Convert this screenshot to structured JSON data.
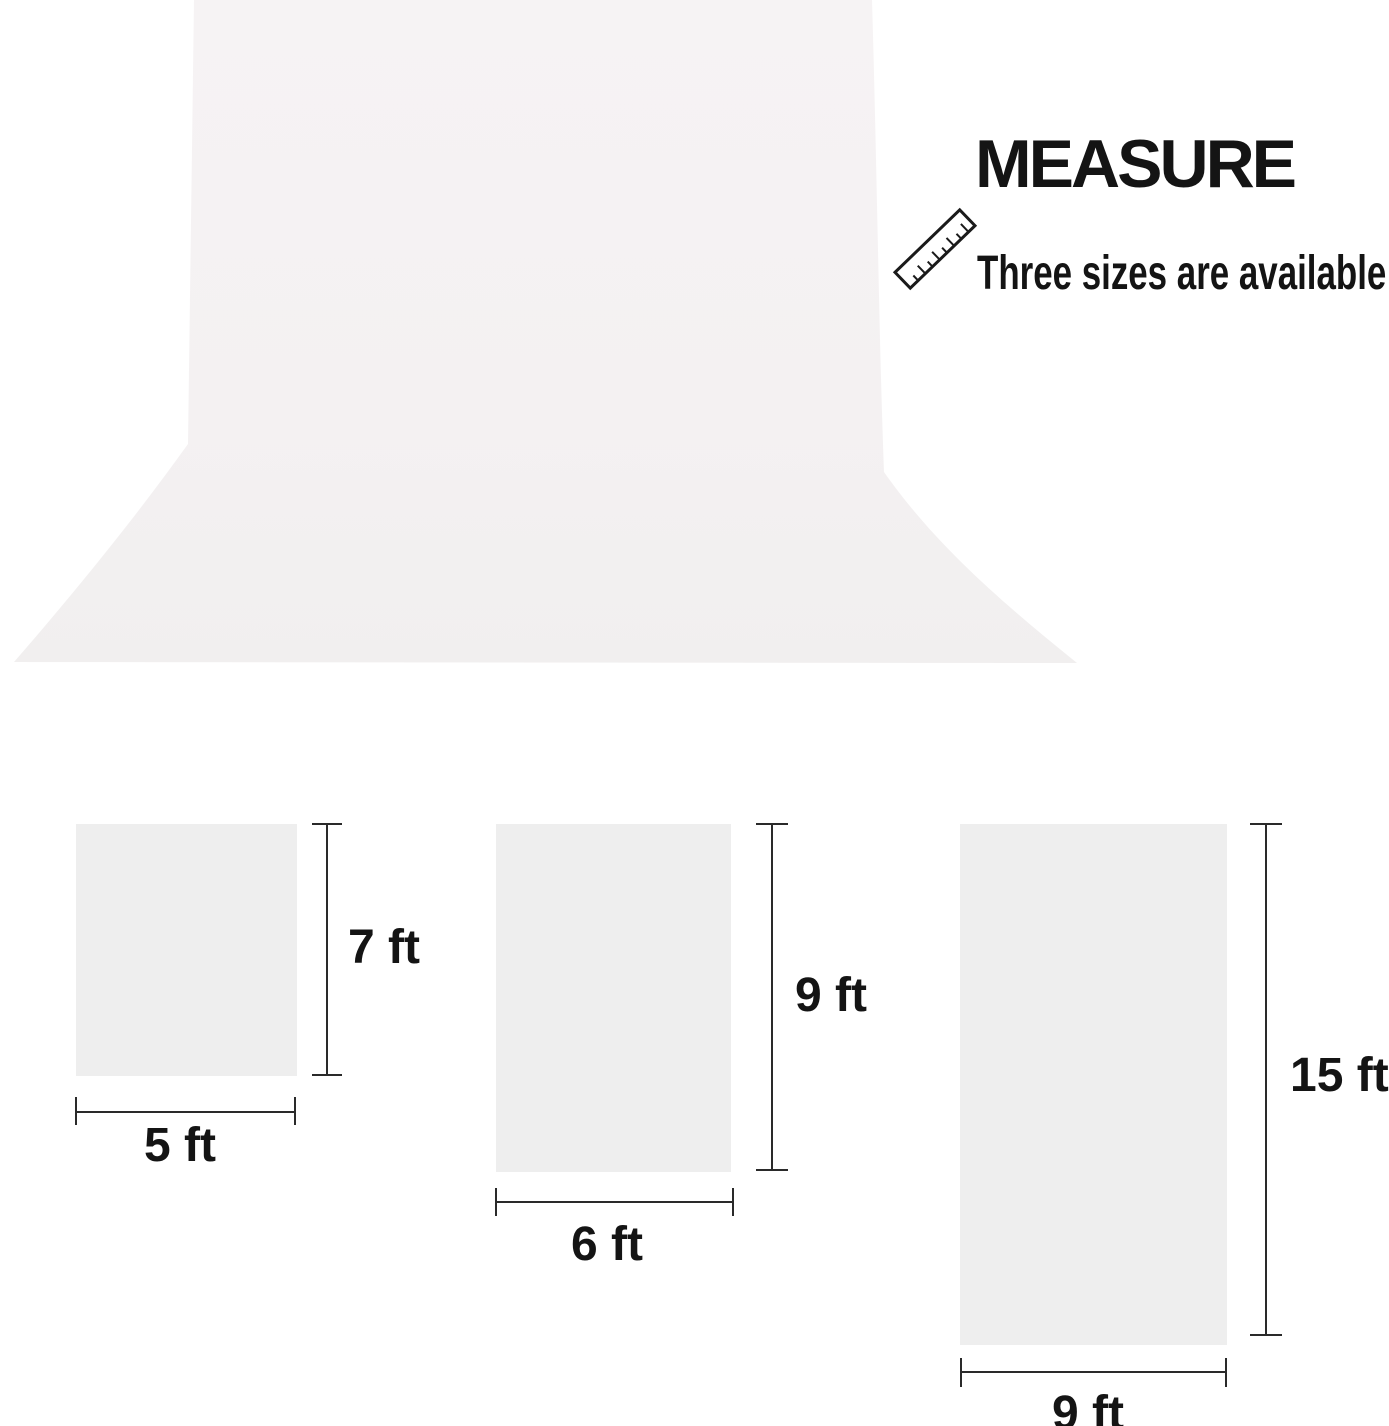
{
  "header": {
    "title": "MEASURE",
    "subtitle": "Three sizes are available"
  },
  "backdrop": {
    "description": "white photography backdrop sweep"
  },
  "sizes": [
    {
      "width_label": "5 ft",
      "height_label": "7 ft"
    },
    {
      "width_label": "6 ft",
      "height_label": "9 ft"
    },
    {
      "width_label": "9 ft",
      "height_label": "15 ft"
    }
  ],
  "colors": {
    "page_bg": "#ffffff",
    "backdrop_top": "#f6f3f4",
    "backdrop_floor": "#f1efef",
    "swatch": "#eeeeee",
    "line": "#2a2a2a",
    "text": "#141414"
  }
}
